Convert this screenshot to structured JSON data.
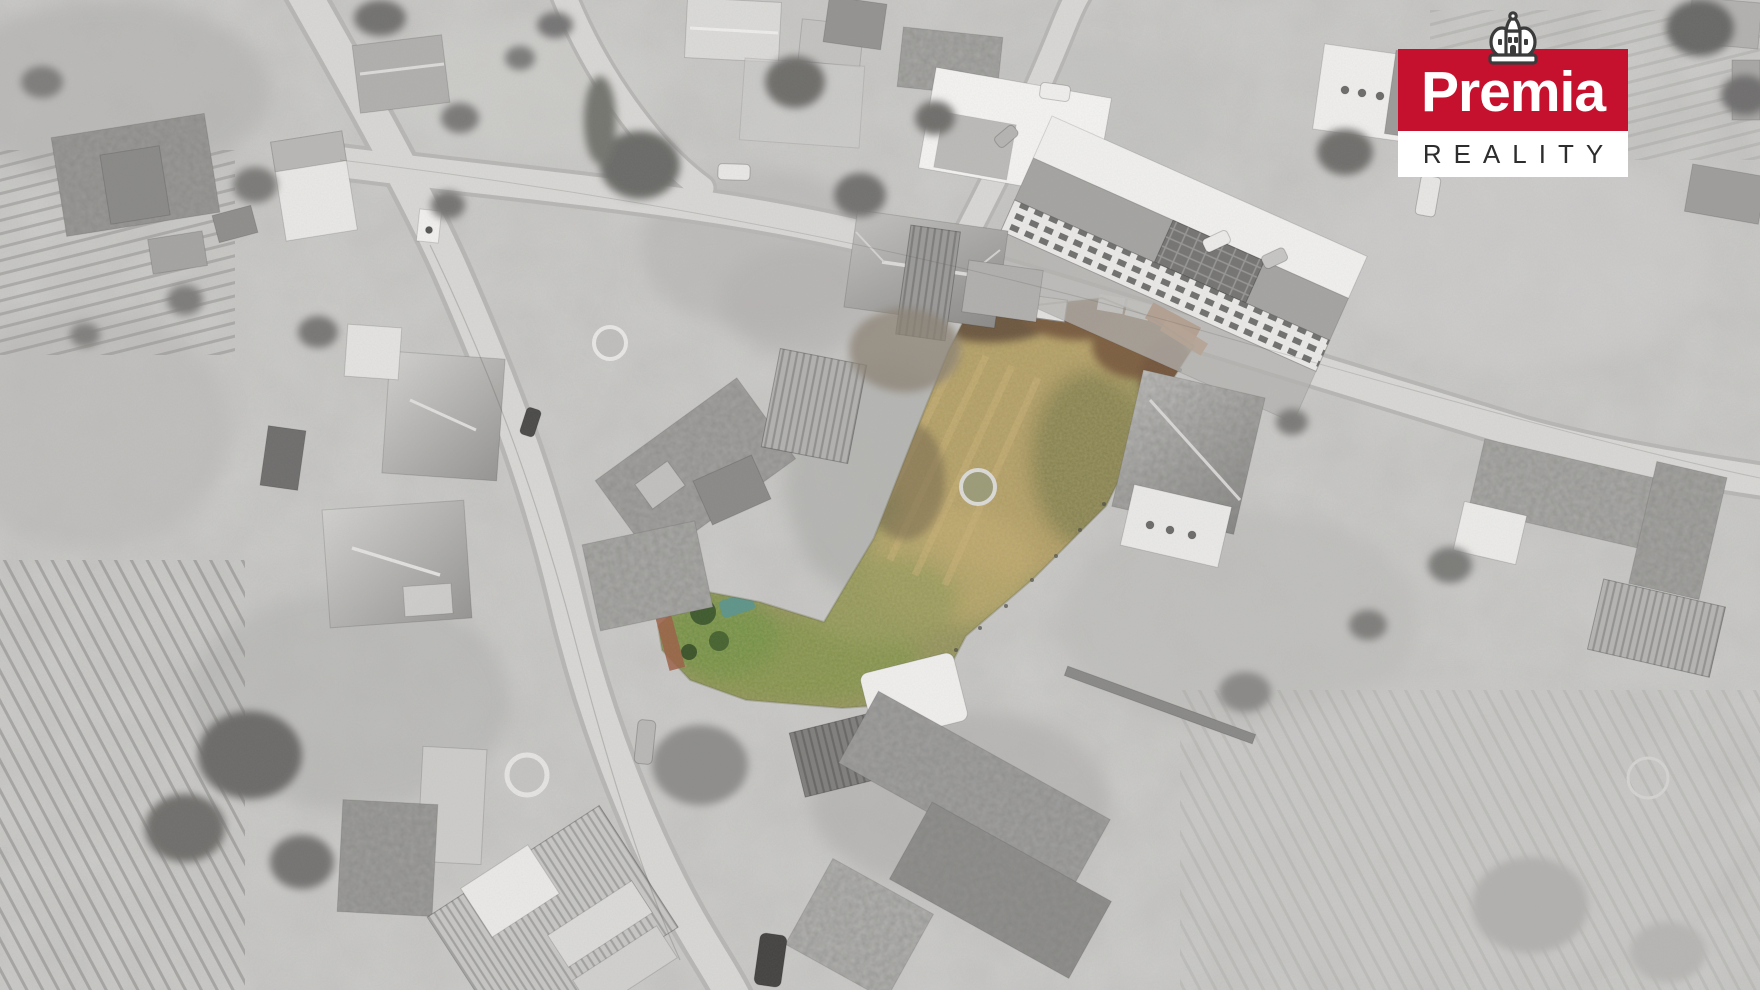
{
  "logo": {
    "brand": "Premia",
    "subtitle": "REALITY",
    "icon": "crown-castle-icon",
    "colors": {
      "brand_red": "#c6112e",
      "logo_bg": "#ffffff",
      "subtitle_text": "#2d2d2d",
      "crown_outline": "#3b3b3b"
    }
  },
  "scene": {
    "type": "aerial-drone-photo",
    "treatment": "grayscale village with color-highlighted land parcel",
    "highlight_colors": {
      "grass_olive": "#8c8b55",
      "grass_tan": "#b49a62",
      "grass_green": "#7b8c45",
      "shrub_brown": "#7a5d40",
      "fence_orange": "#b26b3b"
    }
  }
}
